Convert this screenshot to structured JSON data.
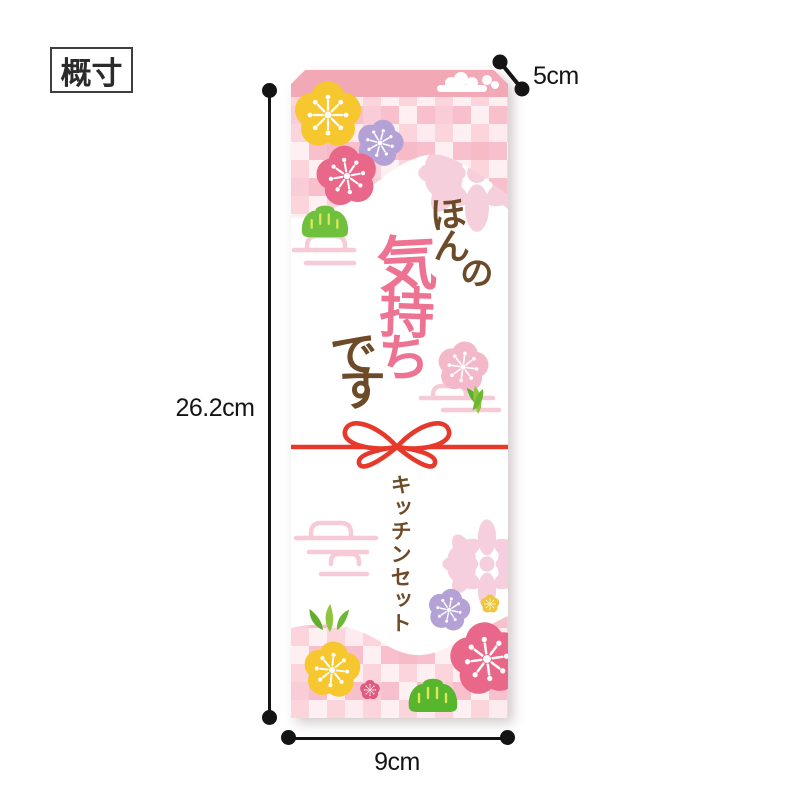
{
  "size_label": "概寸",
  "dimensions": {
    "height": "26.2cm",
    "width": "9cm",
    "flap": "5cm"
  },
  "package": {
    "message": "ほんの気持ちです",
    "message_chars": [
      "ほ",
      "ん",
      "の",
      "気",
      "持",
      "ち",
      "で",
      "す"
    ],
    "product_label": "キッチンセット"
  },
  "colors": {
    "flap_pink": "#f3a8b5",
    "checker_pink": "#f8c0cd",
    "pale_pink": "#f8d8e2",
    "message_brown": "#6d4a28",
    "message_pink": "#ee7292",
    "ribbon_red": "#e6392b",
    "plum_yellow": "#f6c72e",
    "plum_purple": "#b4a2d6",
    "plum_pink": "#e9688a",
    "pine_green": "#6fc13d",
    "dimension_color": "#141414"
  },
  "icons": [
    "plum-blossom-icon",
    "chrysanthemum-icon",
    "pine-icon",
    "bamboo-icon",
    "cloud-icon",
    "ribbon-bow-icon",
    "checkered-pattern"
  ]
}
